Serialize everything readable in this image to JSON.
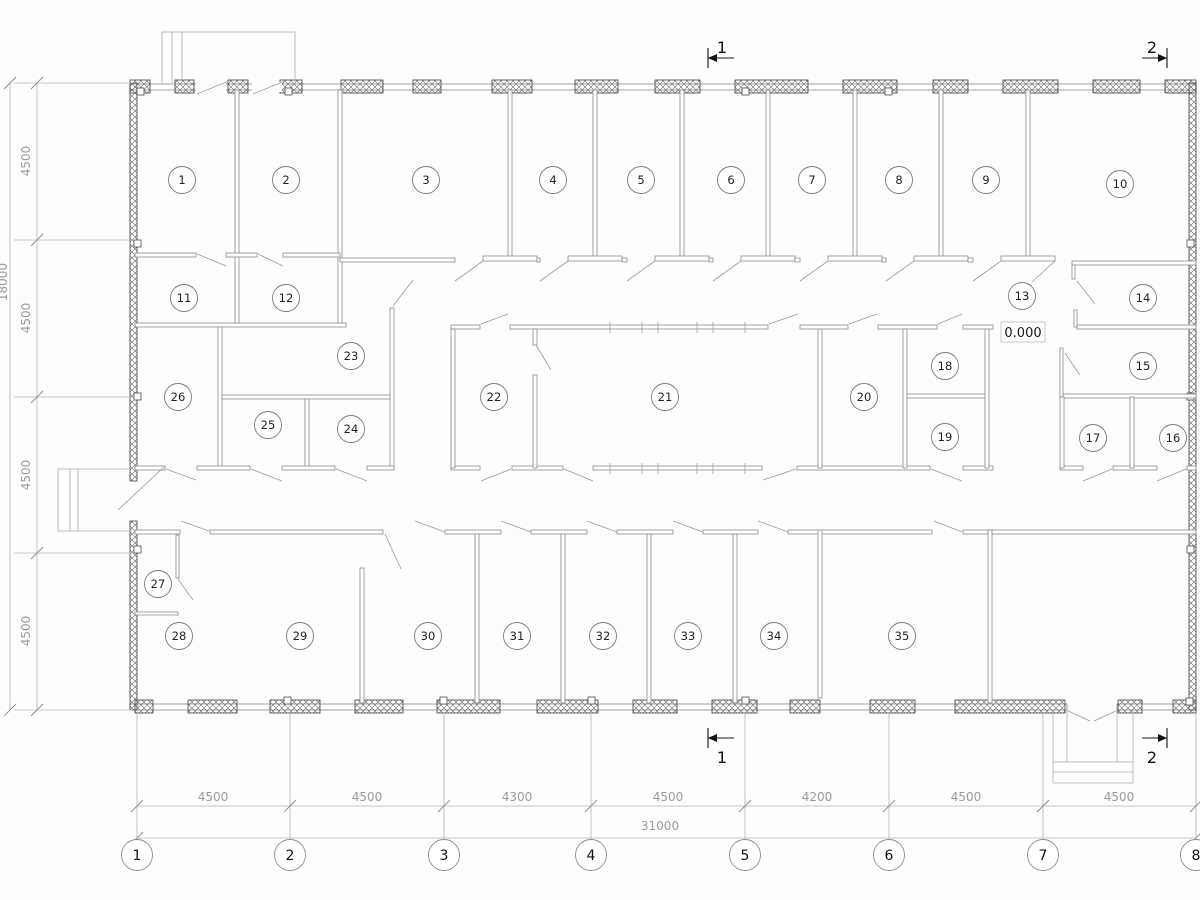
{
  "plan": {
    "elevation": {
      "label": "0.000"
    },
    "rooms": [
      {
        "n": "1",
        "x": 182,
        "y": 180
      },
      {
        "n": "2",
        "x": 286,
        "y": 180
      },
      {
        "n": "3",
        "x": 426,
        "y": 180
      },
      {
        "n": "4",
        "x": 553,
        "y": 180
      },
      {
        "n": "5",
        "x": 641,
        "y": 180
      },
      {
        "n": "6",
        "x": 731,
        "y": 180
      },
      {
        "n": "7",
        "x": 812,
        "y": 180
      },
      {
        "n": "8",
        "x": 899,
        "y": 180
      },
      {
        "n": "9",
        "x": 986,
        "y": 180
      },
      {
        "n": "10",
        "x": 1120,
        "y": 184
      },
      {
        "n": "11",
        "x": 184,
        "y": 298
      },
      {
        "n": "12",
        "x": 286,
        "y": 298
      },
      {
        "n": "13",
        "x": 1022,
        "y": 296
      },
      {
        "n": "14",
        "x": 1143,
        "y": 298
      },
      {
        "n": "15",
        "x": 1143,
        "y": 366
      },
      {
        "n": "16",
        "x": 1173,
        "y": 438
      },
      {
        "n": "17",
        "x": 1093,
        "y": 438
      },
      {
        "n": "18",
        "x": 945,
        "y": 366
      },
      {
        "n": "19",
        "x": 945,
        "y": 437
      },
      {
        "n": "20",
        "x": 864,
        "y": 397
      },
      {
        "n": "21",
        "x": 665,
        "y": 397
      },
      {
        "n": "22",
        "x": 494,
        "y": 397
      },
      {
        "n": "23",
        "x": 351,
        "y": 356
      },
      {
        "n": "24",
        "x": 351,
        "y": 429
      },
      {
        "n": "25",
        "x": 268,
        "y": 425
      },
      {
        "n": "26",
        "x": 178,
        "y": 397
      },
      {
        "n": "27",
        "x": 158,
        "y": 584
      },
      {
        "n": "28",
        "x": 179,
        "y": 636
      },
      {
        "n": "29",
        "x": 300,
        "y": 636
      },
      {
        "n": "30",
        "x": 428,
        "y": 636
      },
      {
        "n": "31",
        "x": 517,
        "y": 636
      },
      {
        "n": "32",
        "x": 603,
        "y": 636
      },
      {
        "n": "33",
        "x": 688,
        "y": 636
      },
      {
        "n": "34",
        "x": 774,
        "y": 636
      },
      {
        "n": "35",
        "x": 902,
        "y": 636
      }
    ],
    "axes": {
      "bubble_y": 855,
      "items": [
        {
          "label": "1",
          "x": 137
        },
        {
          "label": "2",
          "x": 290
        },
        {
          "label": "3",
          "x": 444
        },
        {
          "label": "4",
          "x": 591
        },
        {
          "label": "5",
          "x": 745
        },
        {
          "label": "6",
          "x": 889
        },
        {
          "label": "7",
          "x": 1043
        },
        {
          "label": "8",
          "x": 1196
        }
      ]
    },
    "bottom_dims": {
      "text_y": 801,
      "seg_line_y": 806,
      "total_line_y": 838,
      "items": [
        {
          "label": "4500",
          "x": 213
        },
        {
          "label": "4500",
          "x": 367
        },
        {
          "label": "4300",
          "x": 517
        },
        {
          "label": "4500",
          "x": 668
        },
        {
          "label": "4200",
          "x": 817
        },
        {
          "label": "4500",
          "x": 966
        },
        {
          "label": "4500",
          "x": 1119
        }
      ],
      "total": {
        "label": "31000",
        "x": 660,
        "y": 830
      }
    },
    "left_dims": {
      "text_x": 30,
      "inner_line_x": 37,
      "outer_line_x": 10,
      "ext_ys": [
        83,
        240,
        397,
        553,
        710
      ],
      "items": [
        {
          "label": "4500",
          "y": 161
        },
        {
          "label": "4500",
          "y": 318
        },
        {
          "label": "4500",
          "y": 475
        },
        {
          "label": "4500",
          "y": 631
        }
      ],
      "total": {
        "label": "18000",
        "x": 7,
        "y": 282
      }
    },
    "sections": [
      {
        "label": "1",
        "bar": 708,
        "y1": 48,
        "y2": 68,
        "tail": 734,
        "dir": "left",
        "lx": 722,
        "ly": 53
      },
      {
        "label": "1",
        "bar": 708,
        "y1": 728,
        "y2": 748,
        "tail": 734,
        "dir": "left",
        "lx": 722,
        "ly": 763
      },
      {
        "label": "2",
        "bar": 1167,
        "y1": 48,
        "y2": 68,
        "tail": 1142,
        "dir": "right",
        "lx": 1152,
        "ly": 53
      },
      {
        "label": "2",
        "bar": 1167,
        "y1": 728,
        "y2": 748,
        "tail": 1142,
        "dir": "right",
        "lx": 1152,
        "ly": 763
      }
    ],
    "colors": {
      "wall_line": "#3d3d3d",
      "partition_line": "#8b8b8b",
      "dim_line": "#b3b3b3",
      "dim_text": "#9a9a9a",
      "label_text": "#1a1a1a",
      "paper": "#fdfdfd"
    }
  }
}
